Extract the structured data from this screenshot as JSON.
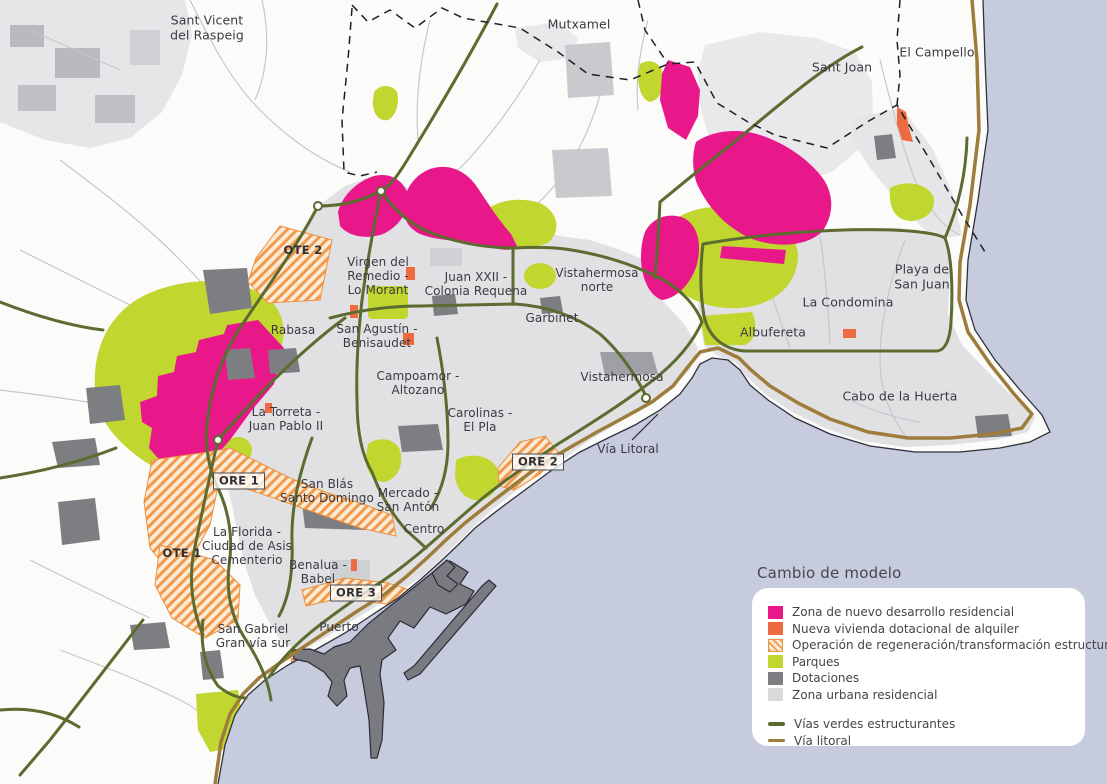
{
  "legend": {
    "title": "Cambio de modelo",
    "items": [
      {
        "label": "Zona de nuevo desarrollo residencial",
        "color": "#e9188a",
        "type": "solid"
      },
      {
        "label": "Nueva vivienda dotacional de alquiler",
        "color": "#ee6b42",
        "type": "solid"
      },
      {
        "label": "Operación de regeneración/transformación estructural",
        "color": "#f09a50",
        "type": "hatched"
      },
      {
        "label": "Parques",
        "color": "#c1d62f",
        "type": "solid"
      },
      {
        "label": "Dotaciones",
        "color": "#7d7e82",
        "type": "solid"
      },
      {
        "label": "Zona urbana residencial",
        "color": "#d9d9dc",
        "type": "solid"
      }
    ],
    "lines": [
      {
        "label": "Vías verdes estructurantes",
        "color": "#5c6b2f"
      },
      {
        "label": "Vía litoral",
        "color": "#9d7c3c"
      }
    ]
  },
  "places": [
    {
      "text": "Sant Vicent\ndel Raspeig"
    },
    {
      "text": "Mutxamel"
    },
    {
      "text": "Sant Joan"
    },
    {
      "text": "El Campello"
    },
    {
      "text": "Playa de\nSan Juan"
    },
    {
      "text": "La Condomina"
    },
    {
      "text": "Albufereta"
    },
    {
      "text": "Cabo de la Huerta"
    },
    {
      "text": "Vistahermosa\nnorte"
    },
    {
      "text": "Vistahermosa"
    },
    {
      "text": "Garbinet"
    },
    {
      "text": "Juan XXII -\nColonia Requena"
    },
    {
      "text": "Virgen del\nRemedio -\nLo Morant"
    },
    {
      "text": "Rabasa"
    },
    {
      "text": "San Agustín -\nBenisaudet"
    },
    {
      "text": "Campoamor -\nAltozano"
    },
    {
      "text": "Carolinas -\nEl Pla"
    },
    {
      "text": "La Torreta -\nJuan Pablo II"
    },
    {
      "text": "San Blás\nSanto Domingo"
    },
    {
      "text": "Mercado -\nSan Antón"
    },
    {
      "text": "Centro"
    },
    {
      "text": "La Florida -\nCiudad de Asis\nCementerio"
    },
    {
      "text": "Benalua -\nBabel"
    },
    {
      "text": "Puerto"
    },
    {
      "text": "San Gabriel\nGran vía sur"
    },
    {
      "text": "Vía Litoral"
    }
  ],
  "zone_tags": [
    {
      "text": "OTE 2"
    },
    {
      "text": "ORE 1"
    },
    {
      "text": "OTE 1"
    },
    {
      "text": "ORE 2"
    },
    {
      "text": "ORE 3"
    }
  ]
}
